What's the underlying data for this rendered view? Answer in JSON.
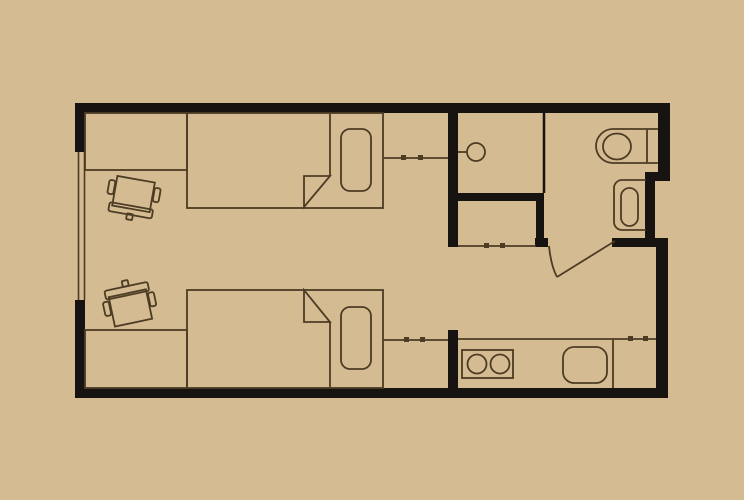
{
  "canvas": {
    "width": 744,
    "height": 500
  },
  "colors": {
    "background": "#d5bb92",
    "wall": "#171310",
    "line": "#4c3c24",
    "floor": "#d5bb92"
  },
  "floorplan": {
    "description": "studio-dorm-floor-plan",
    "walls": [
      {
        "name": "wall-top",
        "x": 75,
        "y": 103,
        "w": 595,
        "h": 10
      },
      {
        "name": "wall-left-upper",
        "x": 75,
        "y": 103,
        "w": 10,
        "h": 49
      },
      {
        "name": "wall-left-lower",
        "x": 75,
        "y": 300,
        "w": 10,
        "h": 98
      },
      {
        "name": "wall-bottom",
        "x": 75,
        "y": 388,
        "w": 593,
        "h": 10
      },
      {
        "name": "wall-right-upper",
        "x": 658,
        "y": 103,
        "w": 12,
        "h": 78
      },
      {
        "name": "wall-right-jog",
        "x": 645,
        "y": 172,
        "w": 25,
        "h": 9
      },
      {
        "name": "wall-bathroom-right",
        "x": 645,
        "y": 172,
        "w": 10,
        "h": 75
      },
      {
        "name": "wall-bathroom-bottom",
        "x": 612,
        "y": 238,
        "w": 56,
        "h": 9
      },
      {
        "name": "wall-right-lower",
        "x": 656,
        "y": 238,
        "w": 12,
        "h": 160
      },
      {
        "name": "wall-core",
        "x": 448,
        "y": 103,
        "w": 10,
        "h": 144
      },
      {
        "name": "wall-closet-top",
        "x": 448,
        "y": 193,
        "w": 96,
        "h": 8
      },
      {
        "name": "wall-closet-right",
        "x": 536,
        "y": 193,
        "w": 8,
        "h": 45
      },
      {
        "name": "wall-door-jamb",
        "x": 535,
        "y": 238,
        "w": 13,
        "h": 9
      },
      {
        "name": "wall-kitchen-stub",
        "x": 448,
        "y": 330,
        "w": 10,
        "h": 58
      }
    ],
    "partitions": [
      {
        "name": "partition-washroom-bathroom",
        "x1": 544,
        "y1": 113,
        "x2": 544,
        "y2": 193,
        "sw": 2.5
      }
    ],
    "window": {
      "name": "window-left",
      "lines": [
        {
          "x1": 78.5,
          "y1": 152,
          "x2": 78.5,
          "y2": 300
        },
        {
          "x1": 84.5,
          "y1": 152,
          "x2": 84.5,
          "y2": 300
        }
      ],
      "sw": 1.6
    },
    "furniture": [
      {
        "t": "rect",
        "name": "desk-top",
        "x": 85,
        "y": 113,
        "w": 102,
        "h": 57
      },
      {
        "t": "g",
        "name": "desk-chair-top",
        "transform": "rotate(10 133 197)",
        "items": [
          {
            "t": "rect",
            "name": "chair-top-seat",
            "x": 114,
            "y": 179,
            "w": 38,
            "h": 30
          },
          {
            "t": "rect",
            "name": "chair-top-backrest",
            "x": 111,
            "y": 206,
            "w": 44,
            "h": 9,
            "rx": 2
          },
          {
            "t": "rect",
            "name": "chair-top-knob",
            "x": 130,
            "y": 214,
            "w": 6,
            "h": 6,
            "rx": 1
          },
          {
            "t": "rect",
            "name": "chair-top-armrest-left",
            "x": 107,
            "y": 184,
            "w": 6,
            "h": 14,
            "rx": 2
          },
          {
            "t": "rect",
            "name": "chair-top-armrest-right",
            "x": 153,
            "y": 184,
            "w": 6,
            "h": 14,
            "rx": 2
          }
        ]
      },
      {
        "t": "rect",
        "name": "bed-top",
        "x": 187,
        "y": 113,
        "w": 196,
        "h": 95
      },
      {
        "t": "rect",
        "name": "pillow-top",
        "x": 341,
        "y": 129,
        "w": 30,
        "h": 62,
        "rx": 9
      },
      {
        "t": "line",
        "name": "blanket-edge-top",
        "x1": 330,
        "y1": 114,
        "x2": 330,
        "y2": 176
      },
      {
        "t": "path",
        "name": "blanket-fold-top",
        "d": "M 330 176 L 304 176 L 304 207 Z"
      },
      {
        "t": "line",
        "name": "wardrobe-top-front",
        "x1": 383,
        "y1": 158,
        "x2": 448,
        "y2": 158
      },
      {
        "t": "rect",
        "name": "wardrobe-top-handle-1",
        "x": 401,
        "y": 155,
        "w": 5,
        "h": 5,
        "fill": true
      },
      {
        "t": "rect",
        "name": "wardrobe-top-handle-2",
        "x": 418,
        "y": 155,
        "w": 5,
        "h": 5,
        "fill": true
      },
      {
        "t": "rect",
        "name": "desk-bottom",
        "x": 85,
        "y": 330,
        "w": 102,
        "h": 58
      },
      {
        "t": "g",
        "name": "desk-chair-bottom",
        "transform": "rotate(-12 130 306)",
        "items": [
          {
            "t": "rect",
            "name": "chair-bottom-seat",
            "x": 111,
            "y": 293,
            "w": 38,
            "h": 30
          },
          {
            "t": "rect",
            "name": "chair-bottom-backrest",
            "x": 108,
            "y": 286,
            "w": 44,
            "h": 9,
            "rx": 2
          },
          {
            "t": "rect",
            "name": "chair-bottom-knob",
            "x": 127,
            "y": 280,
            "w": 6,
            "h": 6,
            "rx": 1
          },
          {
            "t": "rect",
            "name": "chair-bottom-armrest-left",
            "x": 104,
            "y": 297,
            "w": 6,
            "h": 14,
            "rx": 2
          },
          {
            "t": "rect",
            "name": "chair-bottom-armrest-right",
            "x": 150,
            "y": 297,
            "w": 6,
            "h": 14,
            "rx": 2
          }
        ]
      },
      {
        "t": "rect",
        "name": "bed-bottom",
        "x": 187,
        "y": 290,
        "w": 196,
        "h": 98
      },
      {
        "t": "rect",
        "name": "pillow-bottom",
        "x": 341,
        "y": 307,
        "w": 30,
        "h": 62,
        "rx": 9
      },
      {
        "t": "line",
        "name": "blanket-edge-bottom",
        "x1": 330,
        "y1": 322,
        "x2": 330,
        "y2": 387
      },
      {
        "t": "path",
        "name": "blanket-fold-bottom",
        "d": "M 304 322 L 330 322 L 304 290 Z"
      },
      {
        "t": "line",
        "name": "wardrobe-bottom-front",
        "x1": 383,
        "y1": 340,
        "x2": 448,
        "y2": 340
      },
      {
        "t": "rect",
        "name": "wardrobe-bottom-handle-1",
        "x": 404,
        "y": 337,
        "w": 5,
        "h": 5,
        "fill": true
      },
      {
        "t": "rect",
        "name": "wardrobe-bottom-handle-2",
        "x": 420,
        "y": 337,
        "w": 5,
        "h": 5,
        "fill": true
      },
      {
        "t": "line",
        "name": "wash-basin-mount",
        "x1": 458,
        "y1": 152,
        "x2": 467,
        "y2": 152
      },
      {
        "t": "circle",
        "name": "wash-basin",
        "cx": 476,
        "cy": 152,
        "r": 9
      },
      {
        "t": "line",
        "name": "closet-front",
        "x1": 458,
        "y1": 246,
        "x2": 536,
        "y2": 246
      },
      {
        "t": "rect",
        "name": "closet-handle-1",
        "x": 484,
        "y": 243,
        "w": 5,
        "h": 5,
        "fill": true
      },
      {
        "t": "rect",
        "name": "closet-handle-2",
        "x": 500,
        "y": 243,
        "w": 5,
        "h": 5,
        "fill": true
      },
      {
        "t": "path",
        "name": "toilet-body",
        "d": "M 658 129 L 613 129 A 17 17 0 0 0 613 163 L 658 163"
      },
      {
        "t": "line",
        "name": "toilet-tank-front",
        "x1": 647,
        "y1": 129,
        "x2": 647,
        "y2": 163
      },
      {
        "t": "ellipse",
        "name": "toilet-bowl",
        "cx": 617,
        "cy": 146.5,
        "rx": 14,
        "ry": 13
      },
      {
        "t": "path",
        "name": "bathtub-outer",
        "d": "M 646 180 L 622 180 A 8 8 0 0 0 614 188 L 614 222 A 8 8 0 0 0 622 230 L 646 230"
      },
      {
        "t": "rect",
        "name": "bathtub-inner",
        "x": 621,
        "y": 188,
        "w": 17,
        "h": 38,
        "rx": 8.5
      },
      {
        "t": "line",
        "name": "bathroom-door-leaf",
        "x1": 615,
        "y1": 241,
        "x2": 557,
        "y2": 277
      },
      {
        "t": "path",
        "name": "bathroom-door-swing-arc",
        "d": "M 549 246 Q 551 266 557 277"
      },
      {
        "t": "line",
        "name": "kitchen-counter-front",
        "x1": 458,
        "y1": 339,
        "x2": 656,
        "y2": 339
      },
      {
        "t": "line",
        "name": "kitchen-counter-divider",
        "x1": 613,
        "y1": 339,
        "x2": 613,
        "y2": 388
      },
      {
        "t": "rect",
        "name": "cooktop",
        "x": 462,
        "y": 350,
        "w": 51,
        "h": 28
      },
      {
        "t": "circle",
        "name": "cooktop-burner-left",
        "cx": 477,
        "cy": 364,
        "r": 9.5
      },
      {
        "t": "circle",
        "name": "cooktop-burner-right",
        "cx": 500,
        "cy": 364,
        "r": 9.5
      },
      {
        "t": "rect",
        "name": "kitchen-sink",
        "x": 563,
        "y": 347,
        "w": 44,
        "h": 36,
        "rx": 11
      },
      {
        "t": "rect",
        "name": "kitchen-cabinet-handle-1",
        "x": 628,
        "y": 336,
        "w": 5,
        "h": 5,
        "fill": true
      },
      {
        "t": "rect",
        "name": "kitchen-cabinet-handle-2",
        "x": 643,
        "y": 336,
        "w": 5,
        "h": 5,
        "fill": true
      }
    ]
  }
}
